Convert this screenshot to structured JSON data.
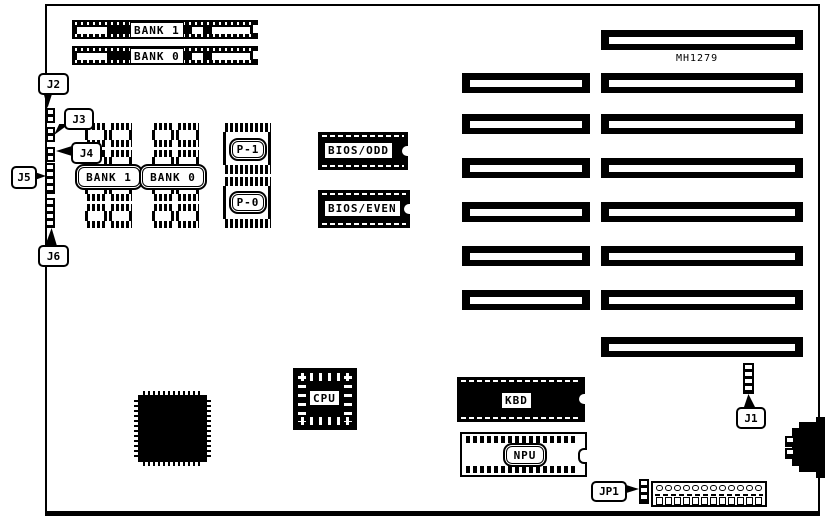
{
  "board": {
    "part_number": "MH1279"
  },
  "simm": {
    "bank1": "BANK 1",
    "bank0": "BANK 0"
  },
  "left_connectors": {
    "j2": "J2",
    "j3": "J3",
    "j4": "J4",
    "j5": "J5",
    "j6": "J6"
  },
  "memory": {
    "bank1": "BANK 1",
    "bank0": "BANK 0",
    "p1": "P-1",
    "p0": "P-0"
  },
  "bios": {
    "odd": "BIOS/ODD",
    "even": "BIOS/EVEN"
  },
  "chips": {
    "cpu": "CPU",
    "kbd": "KBD",
    "npu": "NPU"
  },
  "jumpers": {
    "j1": "J1",
    "jp1": "JP1"
  }
}
